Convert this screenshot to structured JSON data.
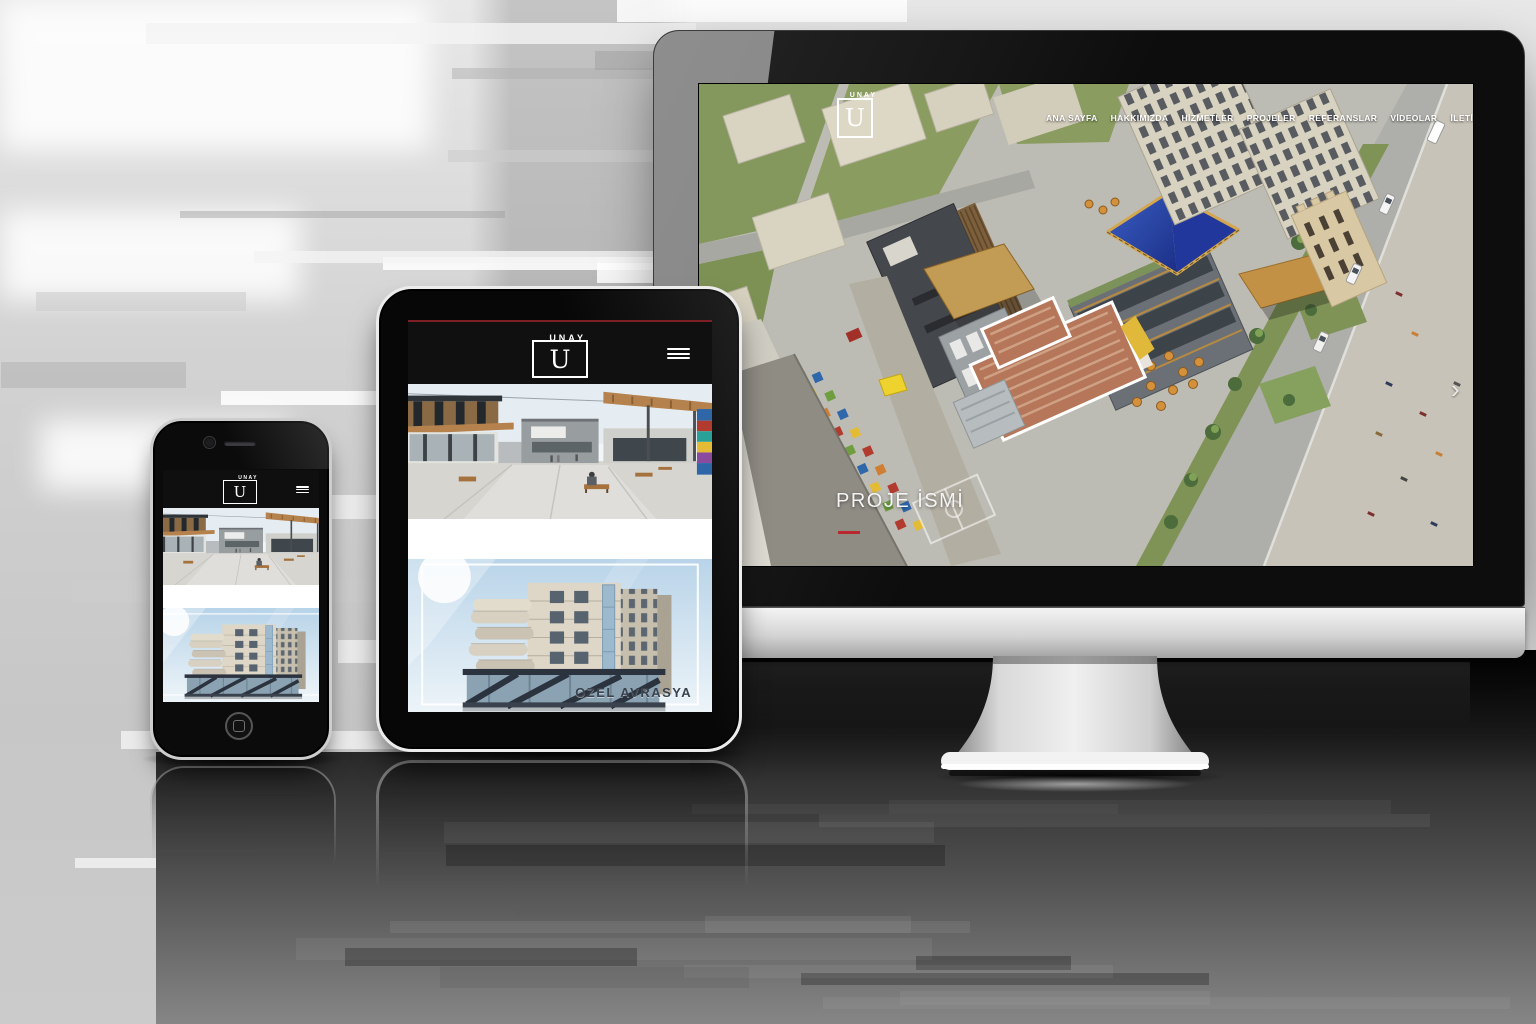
{
  "brand": {
    "name": "UNAY",
    "initial": "U"
  },
  "desktop": {
    "nav_items": [
      "ANA SAYFA",
      "HAKKIMIZDA",
      "HİZMETLER",
      "PROJELER",
      "REFERANSLAR",
      "VİDEOLAR",
      "İLETİŞİM"
    ],
    "hero": {
      "project_title": "PROJE İSMİ"
    },
    "carousel_next": "›"
  },
  "tablet": {
    "project_image_caption": "OZEL AVRASYA"
  },
  "colors": {
    "accent_red": "#b9282e",
    "header_black": "#101010",
    "nav_text": "#ffffff"
  }
}
